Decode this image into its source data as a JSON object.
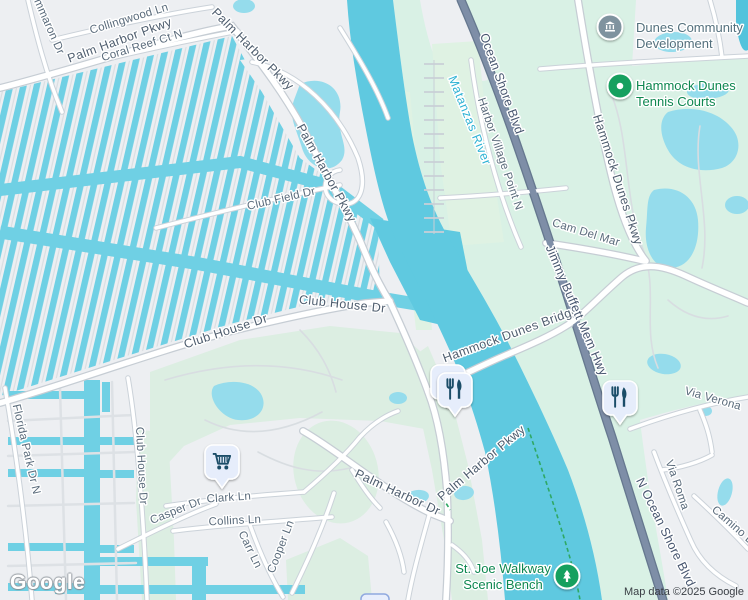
{
  "logo": {
    "text": "Google"
  },
  "attribution": {
    "text": "Map data ©2025 Google"
  },
  "colors": {
    "land": "#EDEFF2",
    "canal": "#6FD0E4",
    "river": "#5FC9E0",
    "pond": "#95DCEC",
    "green_east": "#D9F1E5",
    "green_golf": "#DCEEE2",
    "green_marina": "#DFF2E3",
    "road_white": "#FFFFFF",
    "road_casing": "#C6CDD4",
    "highway": "#7E8EA7",
    "poi_green": "#14A05E",
    "poi_civic": "#7F939F",
    "marker_bg": "#E6EDFB",
    "marker_glyph": "#1B4D68",
    "trail_green": "#2FA864"
  },
  "street_labels": [
    {
      "name": "lbl-cimmaron-dr",
      "text": "mmaron Dr",
      "x": 46,
      "y": 28,
      "r": 66,
      "cls": "st"
    },
    {
      "name": "lbl-collingwood-ln",
      "text": "Collingwood Ln",
      "x": 130,
      "y": 22,
      "r": -17,
      "cls": "st"
    },
    {
      "name": "lbl-palm-harbor-pkwy-nw",
      "text": "Palm Harbor Pkwy",
      "x": 121,
      "y": 44,
      "r": -20,
      "cls": "rd"
    },
    {
      "name": "lbl-coral-reef-ct-n",
      "text": "Coral Reef Ct N",
      "x": 143,
      "y": 49,
      "r": -17,
      "cls": "st"
    },
    {
      "name": "lbl-palm-harbor-pkwy-n",
      "text": "Palm Harbor Pkwy",
      "x": 250,
      "y": 52,
      "r": 45,
      "cls": "rd"
    },
    {
      "name": "lbl-palm-harbor-pkwy-mid",
      "text": "Palm Harbor Pkwy",
      "x": 323,
      "y": 175,
      "r": 61,
      "cls": "rd"
    },
    {
      "name": "lbl-club-field-dr",
      "text": "Club Field Dr",
      "x": 282,
      "y": 202,
      "r": -13,
      "cls": "st"
    },
    {
      "name": "lbl-club-house-dr-e",
      "text": "Club House Dr",
      "x": 342,
      "y": 308,
      "r": 6,
      "cls": "rd"
    },
    {
      "name": "lbl-club-house-dr-w",
      "text": "Club House Dr",
      "x": 227,
      "y": 335,
      "r": -18,
      "cls": "rd"
    },
    {
      "name": "lbl-club-house-dr-s",
      "text": "Club House Dr",
      "x": 138,
      "y": 466,
      "r": 87,
      "cls": "st"
    },
    {
      "name": "lbl-florida-park-dr-n",
      "text": "Florida Park Dr N",
      "x": 23,
      "y": 450,
      "r": 77,
      "cls": "st"
    },
    {
      "name": "lbl-casper-dr",
      "text": "Casper Dr",
      "x": 177,
      "y": 514,
      "r": -22,
      "cls": "st"
    },
    {
      "name": "lbl-clark-ln",
      "text": "Clark Ln",
      "x": 229,
      "y": 501,
      "r": -4,
      "cls": "st"
    },
    {
      "name": "lbl-collins-ln",
      "text": "Collins Ln",
      "x": 235,
      "y": 524,
      "r": -3,
      "cls": "st"
    },
    {
      "name": "lbl-carr-ln",
      "text": "Carr Ln",
      "x": 247,
      "y": 551,
      "r": 64,
      "cls": "st"
    },
    {
      "name": "lbl-cooper-ln",
      "text": "Cooper Ln",
      "x": 284,
      "y": 548,
      "r": -69,
      "cls": "st"
    },
    {
      "name": "lbl-palm-harbor-dr",
      "text": "Palm Harbor Dr",
      "x": 396,
      "y": 496,
      "r": 25,
      "cls": "rd"
    },
    {
      "name": "lbl-palm-harbor-pkwy-s",
      "text": "Palm Harbor Pkwy",
      "x": 484,
      "y": 466,
      "r": -40,
      "cls": "rd"
    },
    {
      "name": "lbl-harbor-village-point-n",
      "text": "Harbor Village Point N",
      "x": 497,
      "y": 155,
      "r": 71,
      "cls": "st"
    },
    {
      "name": "lbl-cam-del-mar",
      "text": "Cam Del Mar",
      "x": 585,
      "y": 236,
      "r": 17,
      "cls": "st"
    },
    {
      "name": "lbl-hammock-dunes-pkwy",
      "text": "Hammock Dunes Pkwy",
      "x": 614,
      "y": 181,
      "r": 72,
      "cls": "rd"
    },
    {
      "name": "lbl-hammock-dunes-bridge",
      "text": "Hammock Dunes Bridge",
      "x": 512,
      "y": 338,
      "r": -20,
      "cls": "rd"
    },
    {
      "name": "lbl-via-verona",
      "text": "Via Verona",
      "x": 712,
      "y": 402,
      "r": 16,
      "cls": "st"
    },
    {
      "name": "lbl-via-roma",
      "text": "Via Roma",
      "x": 674,
      "y": 486,
      "r": 71,
      "cls": "st"
    },
    {
      "name": "lbl-camino-d",
      "text": "Camino D",
      "x": 731,
      "y": 528,
      "r": 41,
      "cls": "st"
    },
    {
      "name": "lbl-ocean-shore-blvd",
      "text": "Ocean Shore Blvd",
      "x": 498,
      "y": 85,
      "r": 70,
      "cls": "hw"
    },
    {
      "name": "lbl-jimmy-buffett-mem-hwy",
      "text": "Jimmy Buffett Mem Hwy",
      "x": 573,
      "y": 312,
      "r": 67,
      "cls": "hw"
    },
    {
      "name": "lbl-n-ocean-shore-blvd",
      "text": "N Ocean Shore Blvd",
      "x": 662,
      "y": 534,
      "r": 64,
      "cls": "hw"
    },
    {
      "name": "lbl-matanzas-river",
      "text": "Matanzas River",
      "x": 466,
      "y": 122,
      "r": 68,
      "cls": "wt"
    }
  ],
  "poi_labels": [
    {
      "name": "poi-label-dunes-community-development",
      "lines": [
        "Dunes Community",
        "Development"
      ],
      "x": 636,
      "y": 32,
      "anchor": "start",
      "cls": "civic"
    },
    {
      "name": "poi-label-hammock-dunes-tennis-courts",
      "lines": [
        "Hammock Dunes",
        "Tennis Courts"
      ],
      "x": 636,
      "y": 90,
      "anchor": "start",
      "cls": "park"
    },
    {
      "name": "poi-label-st-joe-walkway-scenic-bench",
      "lines": [
        "St. Joe Walkway",
        "Scenic Bench"
      ],
      "x": 503,
      "y": 573,
      "anchor": "middle",
      "cls": "park"
    }
  ],
  "markers": [
    {
      "name": "civic-marker-dunes-community",
      "type": "circle",
      "glyph": "bank",
      "x": 610,
      "y": 27,
      "color": "#7F939F"
    },
    {
      "name": "park-marker-tennis-courts",
      "type": "circle",
      "glyph": "dot",
      "x": 620,
      "y": 86,
      "color": "#14A05E"
    },
    {
      "name": "park-marker-scenic-bench",
      "type": "circle",
      "glyph": "tree",
      "x": 567,
      "y": 576,
      "color": "#14A05E"
    },
    {
      "name": "restaurant-marker-stacked",
      "type": "square",
      "glyph": "food",
      "x": 455,
      "y": 390,
      "stacked": true
    },
    {
      "name": "restaurant-marker-east",
      "type": "square",
      "glyph": "food",
      "x": 620,
      "y": 398
    },
    {
      "name": "grocery-marker",
      "type": "square",
      "glyph": "cart",
      "x": 222,
      "y": 462
    },
    {
      "name": "clipped-marker-bottom",
      "type": "clip",
      "x": 361,
      "y": 594,
      "w": 28,
      "h": 12
    }
  ]
}
